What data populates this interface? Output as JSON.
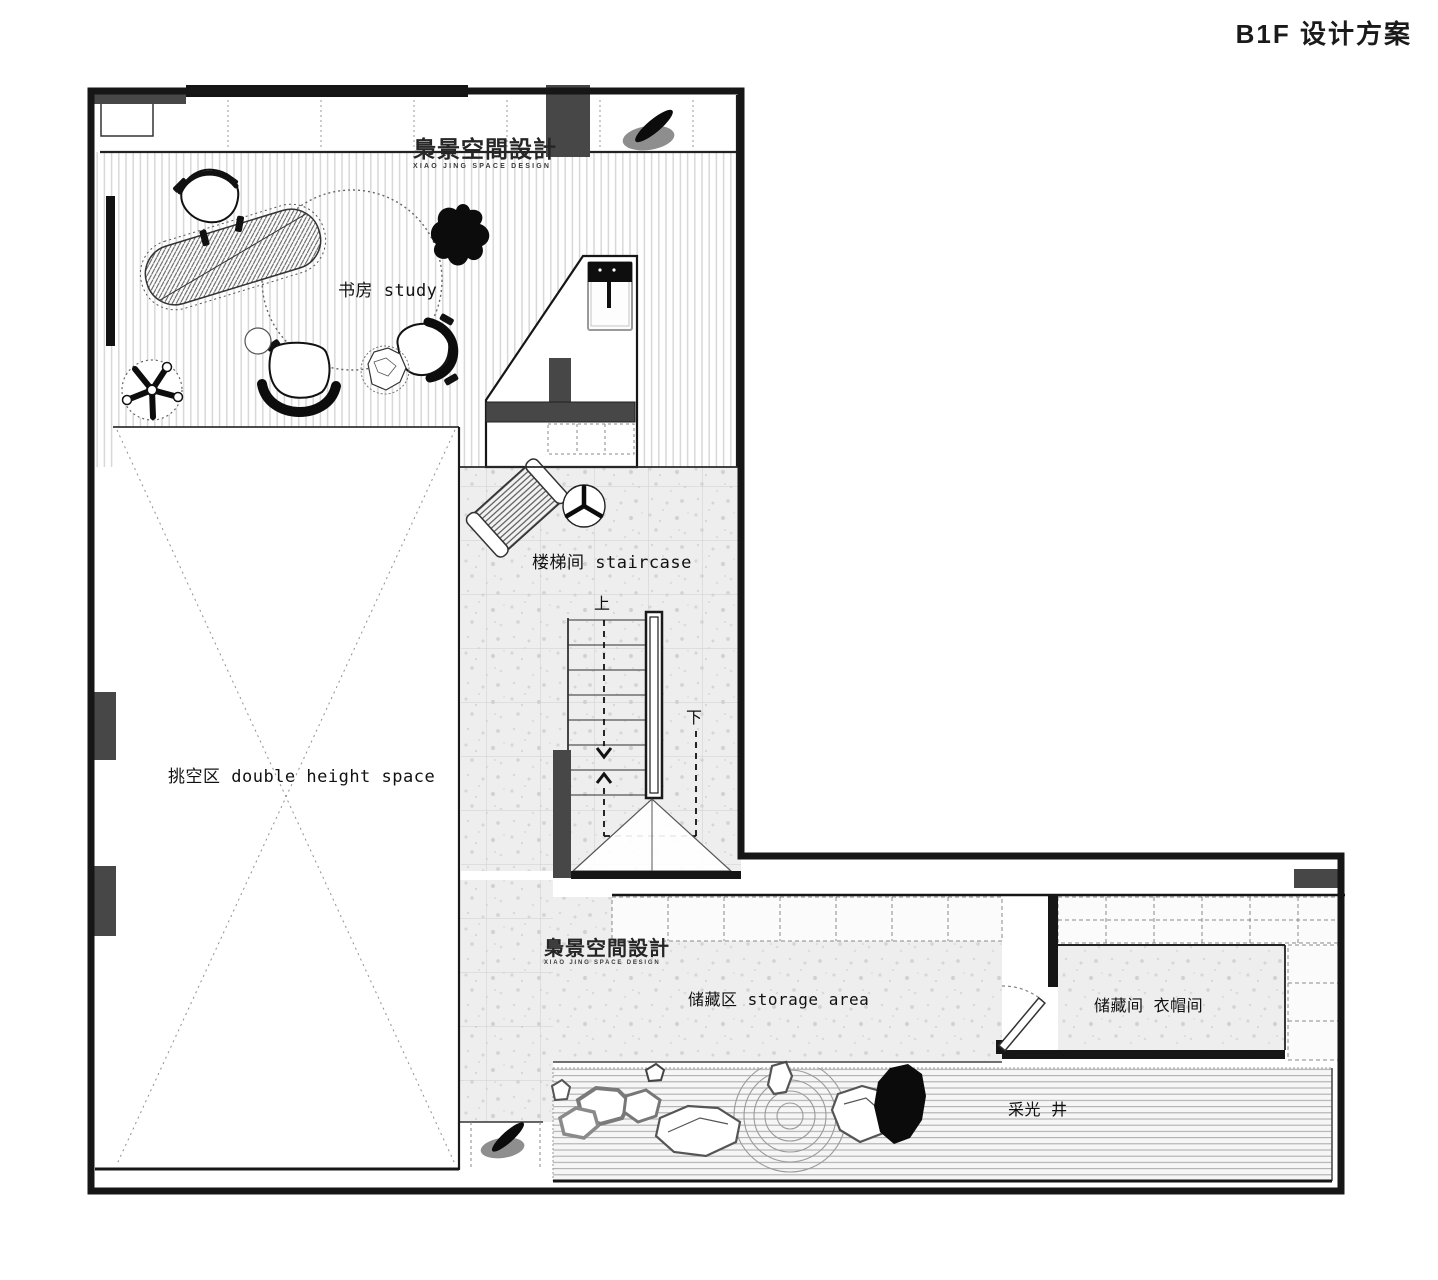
{
  "title": "B1F 设计方案",
  "watermark": {
    "cn": "梟景空間設計",
    "en": "XIAO JING SPACE DESIGN"
  },
  "rooms": {
    "study": "书房 study",
    "staircase": "楼梯间 staircase",
    "double_height": "挑空区 double height space",
    "storage_area": "储藏区 storage area",
    "storage_room": "储藏间 衣帽间",
    "light_well": "采光 井"
  },
  "stairs": {
    "up": "上",
    "down": "下"
  },
  "colors": {
    "wall_black": "#161616",
    "wall_gray": "#474747",
    "floor_stripe": "#d8d8d8",
    "terrazzo": "#eeeeee",
    "ink": "#111111"
  }
}
